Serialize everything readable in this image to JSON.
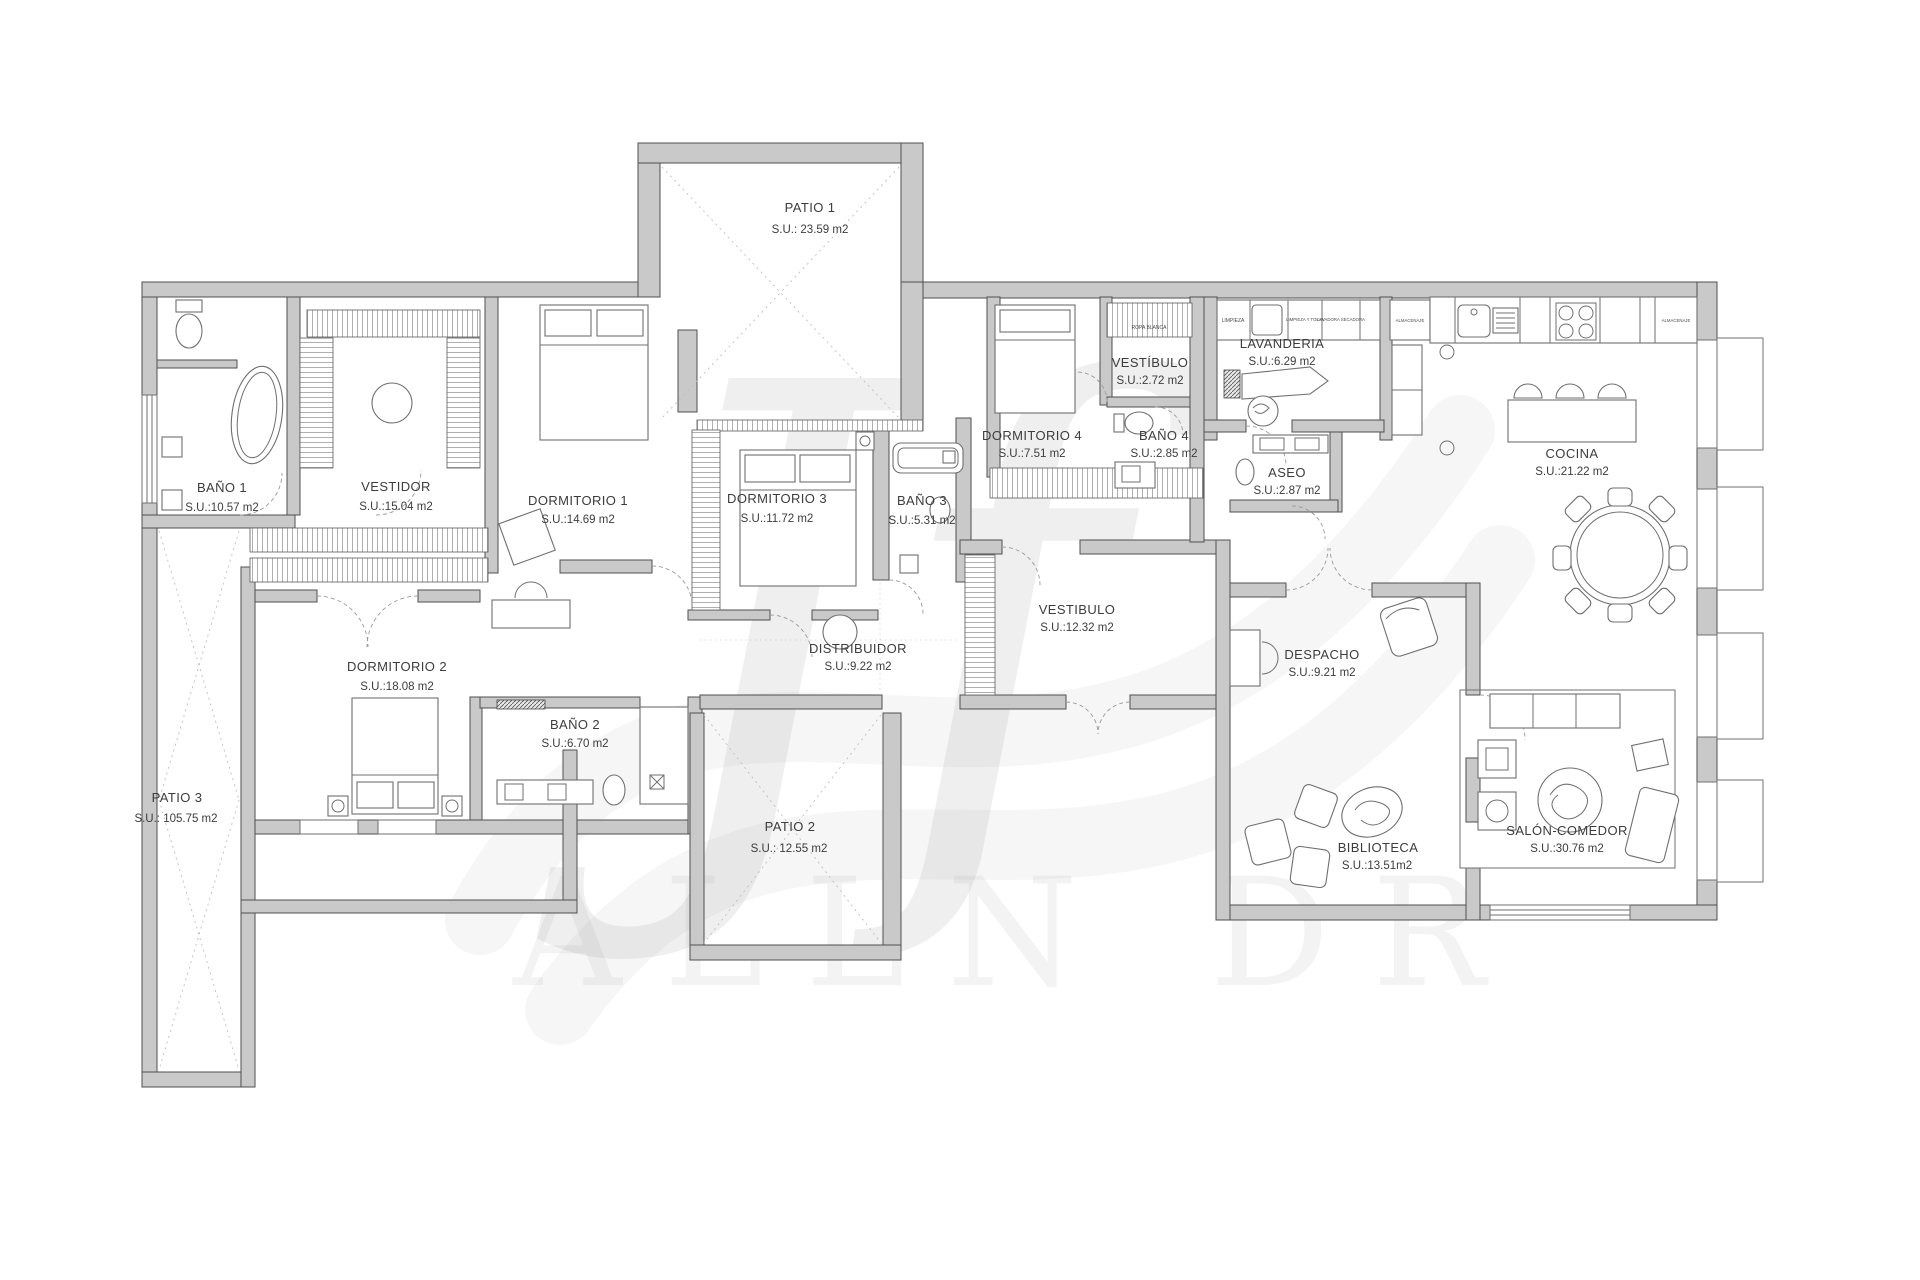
{
  "watermark": {
    "monogram": "Jf",
    "band_text": "ALLN DR"
  },
  "rooms": {
    "patio1": {
      "name": "PATIO 1",
      "area": "S.U.: 23.59 m2"
    },
    "bano1": {
      "name": "BAÑO 1",
      "area": "S.U.:10.57 m2"
    },
    "vestidor": {
      "name": "VESTIDOR",
      "area": "S.U.:15.04 m2"
    },
    "dormitorio1": {
      "name": "DORMITORIO 1",
      "area": "S.U.:14.69 m2"
    },
    "dormitorio2": {
      "name": "DORMITORIO 2",
      "area": "S.U.:18.08 m2"
    },
    "bano2": {
      "name": "BAÑO 2",
      "area": "S.U.:6.70 m2"
    },
    "dormitorio3": {
      "name": "DORMITORIO 3",
      "area": "S.U.:11.72 m2"
    },
    "bano3": {
      "name": "BAÑO 3",
      "area": "S.U.:5.31 m2"
    },
    "dormitorio4": {
      "name": "DORMITORIO 4",
      "area": "S.U.:7.51 m2"
    },
    "vestibulo_peq": {
      "name": "VESTÍBULO",
      "area": "S.U.:2.72 m2"
    },
    "bano4": {
      "name": "BAÑO 4",
      "area": "S.U.:2.85 m2"
    },
    "lavanderia": {
      "name": "LAVANDERIA",
      "area": "S.U.:6.29 m2"
    },
    "aseo": {
      "name": "ASEO",
      "area": "S.U.:2.87 m2"
    },
    "cocina": {
      "name": "COCINA",
      "area": "S.U.:21.22 m2"
    },
    "vestibulo": {
      "name": "VESTIBULO",
      "area": "S.U.:12.32 m2"
    },
    "distribuidor": {
      "name": "DISTRIBUIDOR",
      "area": "S.U.:9.22 m2"
    },
    "despacho": {
      "name": "DESPACHO",
      "area": "S.U.:9.21 m2"
    },
    "patio2": {
      "name": "PATIO 2",
      "area": "S.U.: 12.55 m2"
    },
    "patio3": {
      "name": "PATIO 3",
      "area": "S.U.: 105.75 m2"
    },
    "biblioteca": {
      "name": "BIBLIOTECA",
      "area": "S.U.:13.51m2"
    },
    "salon": {
      "name": "SALÓN-COMEDOR",
      "area": "S.U.:30.76 m2"
    }
  },
  "fixtures": {
    "ropa_blanca": "ROPA BLANCA",
    "limpieza": "LIMPIEZA",
    "limpieza_tolva": "LIMPIEZA Y TOLVA",
    "lavadora_secadora": "LAVADORA SECADORA",
    "almacenaje_lavanderia": "ALMACENAJE",
    "almacenaje_cocina": "ALMACENAJE"
  },
  "colors": {
    "wall": "#c9c9c9",
    "wall_stroke": "#4f4f4f",
    "line": "#6f6f6f",
    "label": "#3c3c3c"
  }
}
